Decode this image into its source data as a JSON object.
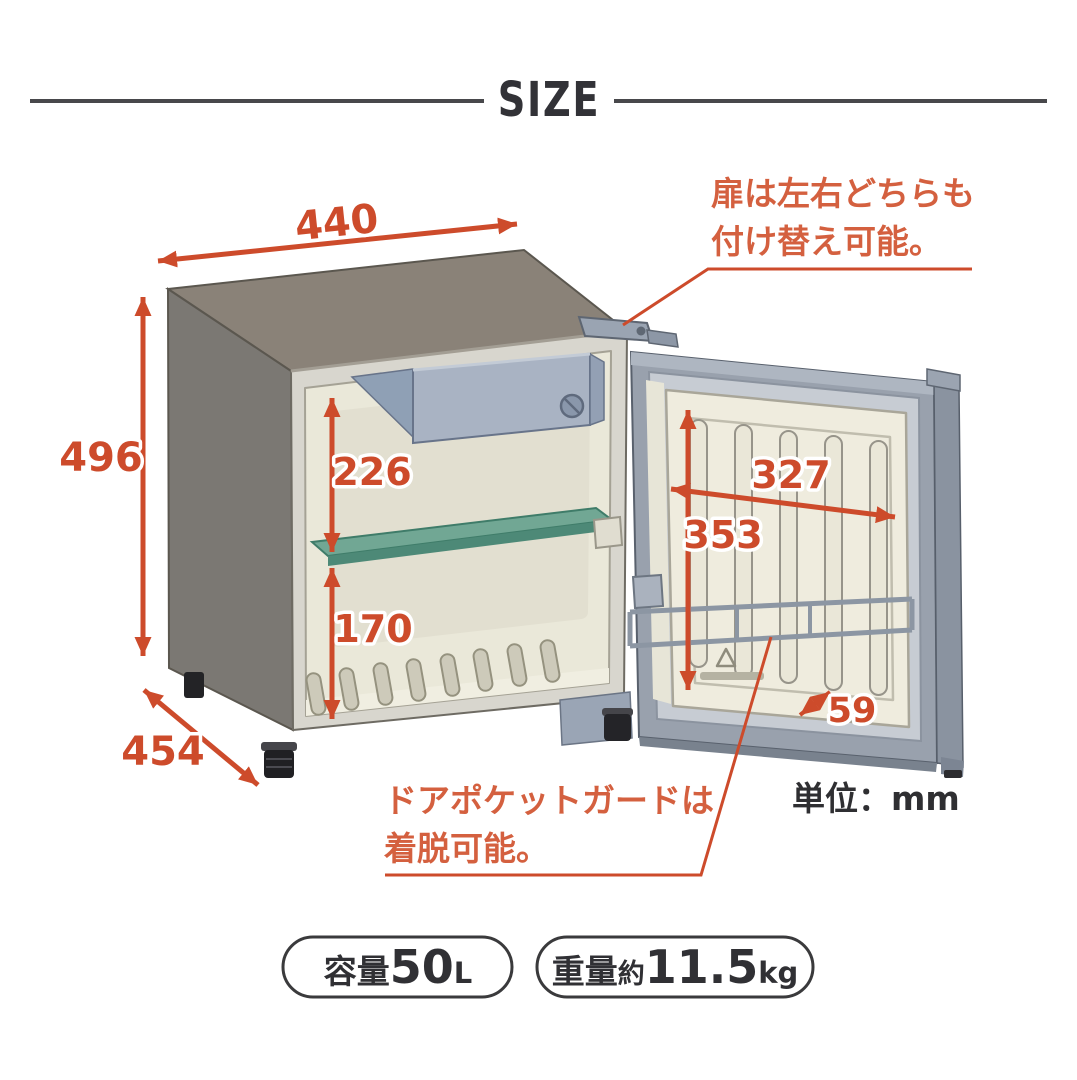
{
  "title": "SIZE",
  "notes": {
    "door_note_line1": "扉は左右どちらも",
    "door_note_line2": "付け替え可能。",
    "pocket_note_line1": "ドアポケットガードは",
    "pocket_note_line2": "着脱可能。",
    "unit_label": "単位：mm"
  },
  "dimensions": {
    "outer_width_mm": "440",
    "outer_height_mm": "496",
    "outer_depth_mm": "454",
    "interior_upper_height_mm": "226",
    "interior_lower_height_mm": "170",
    "door_inner_width_mm": "327",
    "door_inner_height_mm": "353",
    "door_pocket_depth_mm": "59"
  },
  "badges": {
    "capacity": {
      "label": "容量",
      "value": "50",
      "unit": "L"
    },
    "weight": {
      "label": "重量",
      "approx": "約",
      "value": "11.5",
      "unit": "kg"
    }
  },
  "colors": {
    "dimension_accent": "#cd4b2b",
    "note_accent": "#d4603f",
    "dark_text": "#2f2f32",
    "cabinet_top": "#8a8278",
    "cabinet_side": "#7b7873",
    "interior_cream": "#eae8d9",
    "shelf_green": "#71a794",
    "freezer_blue": "#a9b3c3",
    "door_gray": "#99a1ad",
    "door_panel_cream": "#efecde"
  }
}
